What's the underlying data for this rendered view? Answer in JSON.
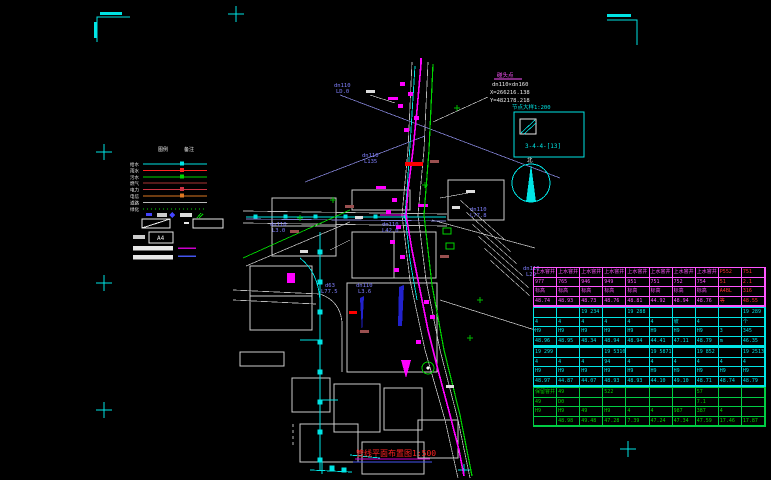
{
  "colors": {
    "cyan": "#00e5e5",
    "magenta": "#ff00ff",
    "green": "#00d400",
    "red": "#ff2222",
    "blue_label": "#8080ff",
    "white": "#e8e8e8",
    "brown": "#9a5050",
    "orange": "#dd7722",
    "gray": "#bbbbbb",
    "dark_blue": "#2222cc"
  },
  "annotation": {
    "tag": "碰头点",
    "pipe": "dn110×dn160",
    "coord_x": "X=266216.138",
    "coord_y": "Y=482178.218"
  },
  "detail_box": {
    "title": "节点大样1:200",
    "code": "3-4-4-[13]"
  },
  "north_arrow": {
    "label": "北"
  },
  "title_block": {
    "text": "管线平面布置图1:500"
  },
  "legend": {
    "headers": [
      "图例",
      "备注"
    ],
    "scale_value": "A4",
    "rows": [
      {
        "label": "给水",
        "color": "#00e5e5",
        "style": "solid",
        "marker": true
      },
      {
        "label": "雨水",
        "color": "#ff2222",
        "style": "solid",
        "marker": true
      },
      {
        "label": "污水",
        "color": "#00d400",
        "style": "solid",
        "marker": true
      },
      {
        "label": "燃气",
        "color": "#aa3333",
        "style": "solid",
        "marker": false
      },
      {
        "label": "电力",
        "color": "#cc3344",
        "style": "solid",
        "marker": true
      },
      {
        "label": "电信",
        "color": "#dd7722",
        "style": "solid",
        "marker": true
      },
      {
        "label": "道路",
        "color": "#bbbbbb",
        "style": "solid",
        "marker": false
      },
      {
        "label": "绿化",
        "color": "#00d400",
        "style": "dotted",
        "marker": false
      }
    ]
  },
  "map": {
    "labels": [
      {
        "t": "dn110",
        "x": 334,
        "y": 87,
        "c": "#8080ff"
      },
      {
        "t": "LD.0",
        "x": 336,
        "y": 93,
        "c": "#8080ff"
      },
      {
        "t": "dn110",
        "x": 362,
        "y": 157,
        "c": "#8080ff"
      },
      {
        "t": "L135",
        "x": 364,
        "y": 163,
        "c": "#8080ff"
      },
      {
        "t": "dn110",
        "x": 270,
        "y": 226,
        "c": "#8080ff"
      },
      {
        "t": "L3.0",
        "x": 272,
        "y": 232,
        "c": "#8080ff"
      },
      {
        "t": "dn110",
        "x": 382,
        "y": 226,
        "c": "#8080ff"
      },
      {
        "t": "L42.0",
        "x": 382,
        "y": 232,
        "c": "#8080ff"
      },
      {
        "t": "d63",
        "x": 325,
        "y": 287,
        "c": "#8080ff"
      },
      {
        "t": "L77.5",
        "x": 321,
        "y": 293,
        "c": "#8080ff"
      },
      {
        "t": "dn110",
        "x": 356,
        "y": 287,
        "c": "#8080ff"
      },
      {
        "t": "L3.6",
        "x": 358,
        "y": 293,
        "c": "#8080ff"
      },
      {
        "t": "dn110",
        "x": 470,
        "y": 211,
        "c": "#8080ff"
      },
      {
        "t": "L77.8",
        "x": 470,
        "y": 217,
        "c": "#8080ff"
      },
      {
        "t": "dn110",
        "x": 523,
        "y": 270,
        "c": "#8080ff"
      },
      {
        "t": "L29",
        "x": 526,
        "y": 276,
        "c": "#8080ff"
      }
    ]
  },
  "table": {
    "groups": [
      {
        "border": "#ff55ff",
        "text": "#ff55ff",
        "red_cols": [
          8,
          9
        ],
        "rows": [
          [
            "上水窨井",
            "上水窨井",
            "上水窨井",
            "上水窨井",
            "上水窨井",
            "上水窨井",
            "上水窨井",
            "上水窨井",
            "P552",
            "751"
          ],
          [
            "977",
            "765",
            "946",
            "949",
            "951",
            "751",
            "752",
            "754",
            "51",
            "2.1"
          ],
          [
            "标高",
            "标高",
            "标高",
            "标高",
            "标高",
            "标高",
            "标高",
            "标高",
            "A4BL",
            "316"
          ],
          [
            "48.74",
            "48.93",
            "48.73",
            "48.76",
            "48.81",
            "44.92",
            "48.94",
            "48.76",
            "等",
            "48.55"
          ]
        ]
      },
      {
        "border": "#00e5e5",
        "text": "#00e5e5",
        "red_cols": [],
        "rows": [
          [
            "",
            "",
            "19 234",
            "",
            "19 288",
            "",
            "",
            "",
            "",
            "19 289"
          ],
          [
            "4",
            "4",
            "4",
            "4",
            "4",
            "4",
            "坡",
            "4",
            "",
            "个"
          ],
          [
            "H9",
            "H9",
            "H9",
            "H9",
            "H9",
            "H9",
            "H9",
            "H9",
            "3",
            "345"
          ],
          [
            "48.96",
            "48.95",
            "48.34",
            "48.94",
            "48.94",
            "44.41",
            "47.11",
            "48.79",
            "m",
            "46.35"
          ]
        ]
      },
      {
        "border": "#00e5e5",
        "text": "#00e5e5",
        "red_cols": [],
        "rows": [
          [
            "19 299",
            "",
            "",
            "19 5310",
            "",
            "19 5871",
            "",
            "19 852",
            "",
            "19 2513"
          ],
          [
            "4",
            "4",
            "4",
            "94",
            "4",
            "4",
            "4",
            "4",
            "4",
            "4"
          ],
          [
            "H9",
            "H9",
            "H9",
            "H9",
            "H9",
            "H9",
            "H9",
            "H9",
            "H9",
            "H9"
          ],
          [
            "48.97",
            "44.87",
            "44.07",
            "48.93",
            "48.93",
            "44.10",
            "49.10",
            "48.71",
            "48.74",
            "48.79"
          ]
        ]
      },
      {
        "border": "#00cc44",
        "text": "#00d400",
        "red_cols": [],
        "rows": [
          [
            "保留窨井",
            "49",
            "",
            "522",
            "",
            "",
            "",
            "57",
            "",
            ""
          ],
          [
            "49",
            "D0",
            "",
            "",
            "",
            "",
            "",
            "7.1",
            "",
            ""
          ],
          [
            "H9",
            "H9",
            "49",
            "H9",
            "4",
            "4",
            "987",
            "387",
            "4",
            ""
          ],
          [
            "",
            "48.98",
            "49.48",
            "47.28",
            "7.39",
            "47.24",
            "47.34",
            "47.59",
            "17.46",
            "17.87"
          ]
        ]
      }
    ]
  }
}
